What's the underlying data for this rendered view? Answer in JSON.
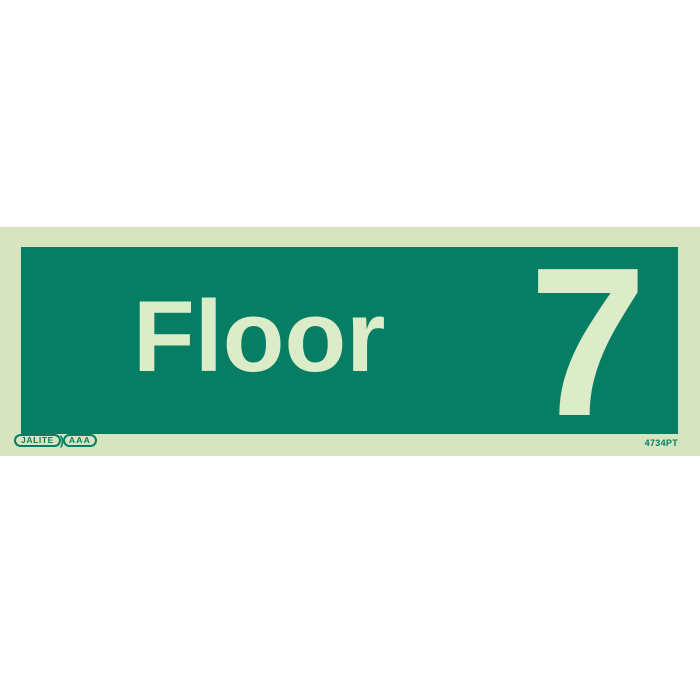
{
  "sign": {
    "floor_label": "Floor",
    "floor_number": "7",
    "product_code": "4734PT",
    "brand": {
      "name": "JALITE",
      "separator": ")",
      "grade": "AAA"
    },
    "colors": {
      "background": "#ffffff",
      "panel": "#d6e5c0",
      "sign_face": "#067e64",
      "text": "#dcebc8",
      "brand_green": "#067e64"
    }
  }
}
